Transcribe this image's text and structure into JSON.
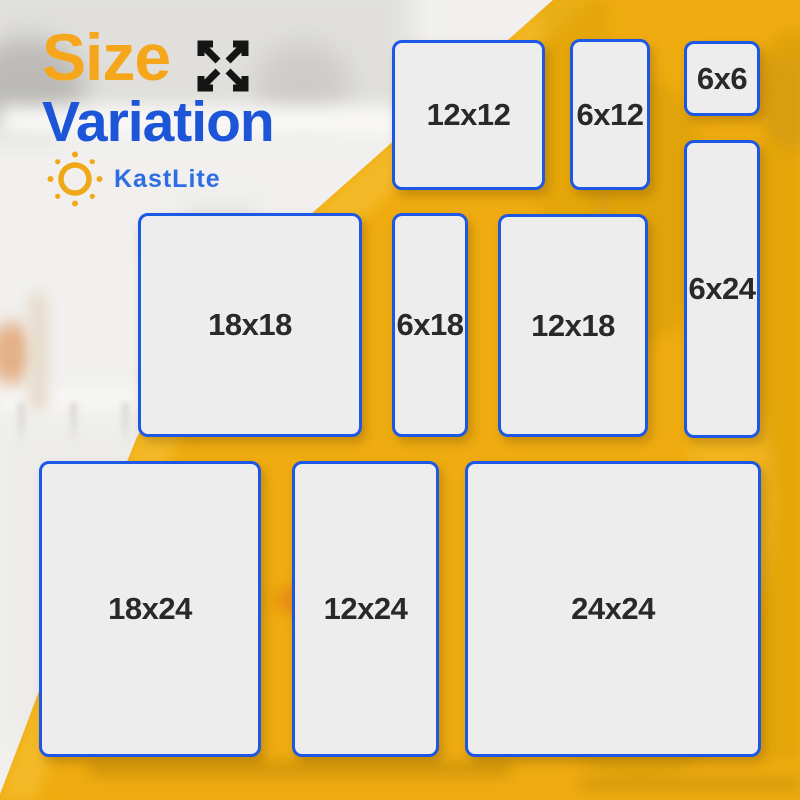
{
  "title": {
    "line1": "Size",
    "line2": "Variation"
  },
  "brand": {
    "name": "KastLite"
  },
  "icons": {
    "expand": "expand-arrows-icon",
    "sun": "sun-icon"
  },
  "colors": {
    "background_yellow": "#efac10",
    "tile_border_blue": "#1d57e5",
    "tile_fill": "#ededee",
    "tile_text": "#29292b",
    "title_orange": "#f5a61a",
    "title_blue": "#1d55d9",
    "brand_blue": "#2e6ee2",
    "sun_orange": "#f0a818",
    "icon_black": "#151515"
  },
  "tiles": [
    {
      "label": "12x12"
    },
    {
      "label": "6x12"
    },
    {
      "label": "6x6"
    },
    {
      "label": "6x24"
    },
    {
      "label": "18x18"
    },
    {
      "label": "6x18"
    },
    {
      "label": "12x18"
    },
    {
      "label": "18x24"
    },
    {
      "label": "12x24"
    },
    {
      "label": "24x24"
    }
  ]
}
